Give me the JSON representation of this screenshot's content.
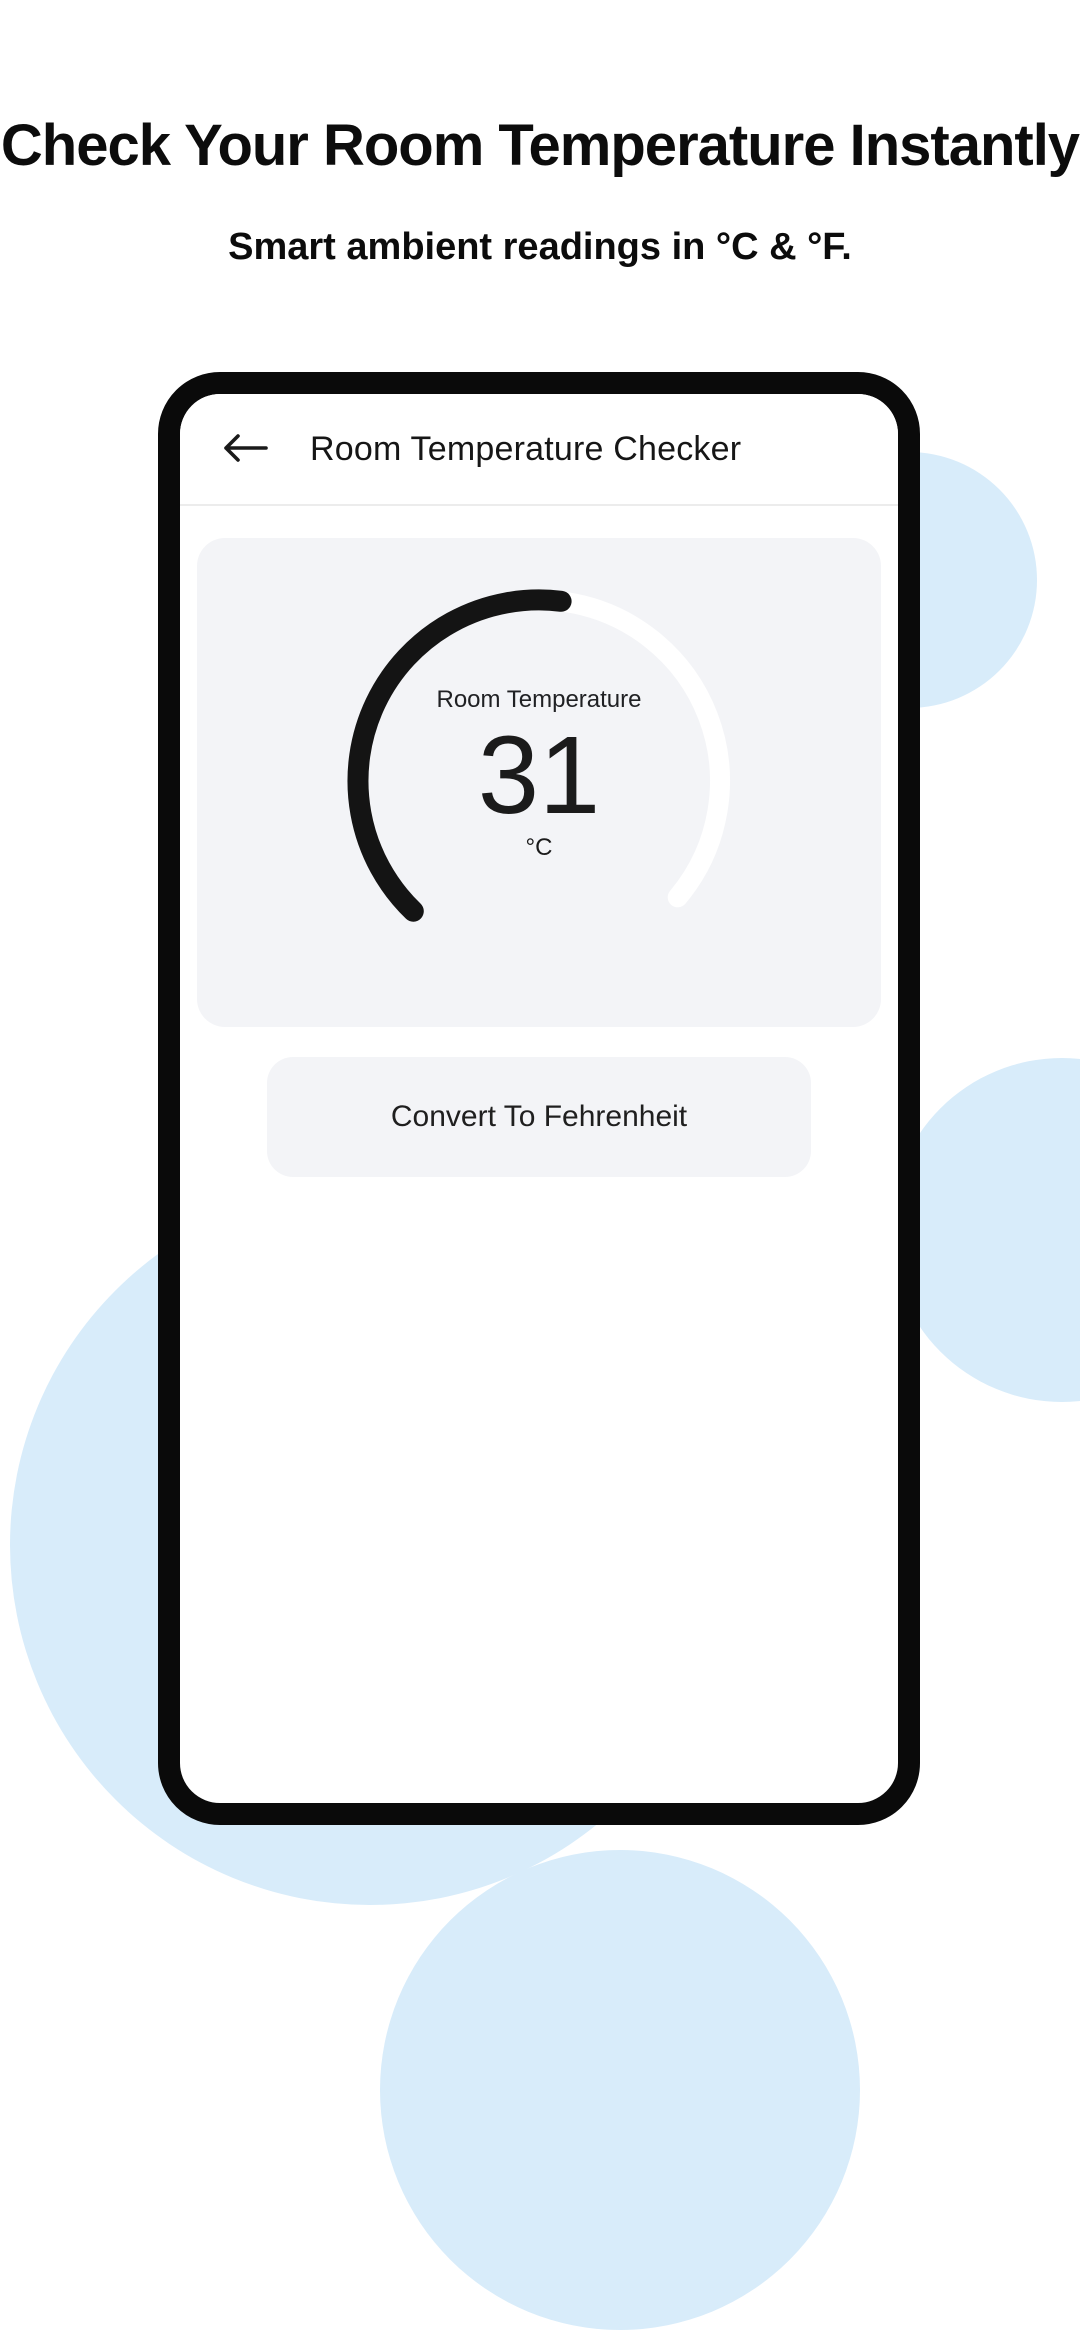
{
  "page": {
    "heading": "Check Your Room Temperature Instantly",
    "subheading": "Smart ambient readings in °C & °F."
  },
  "colors": {
    "background_circle": "#d8ecfa",
    "gauge_filled_arc": "#141414",
    "gauge_track_arc": "#ffffff",
    "phone_frame": "#0a0a0a",
    "card_background": "#f3f4f7"
  },
  "phone": {
    "app_bar": {
      "back_icon": "arrow-left",
      "title": "Room Temperature Checker"
    },
    "gauge_card": {
      "label": "Room Temperature",
      "value": "31",
      "unit": "°C"
    },
    "convert_button": {
      "label": "Convert To Fehrenheit"
    }
  },
  "chart_data": {
    "type": "gauge",
    "title": "Room Temperature",
    "value": 31,
    "unit": "°C",
    "filled_start_deg": 134,
    "filled_end_deg": 277,
    "track_start_deg": 278,
    "track_end_deg": 400,
    "radius": 181,
    "stroke_width": 21,
    "filled_fraction": 0.54
  }
}
